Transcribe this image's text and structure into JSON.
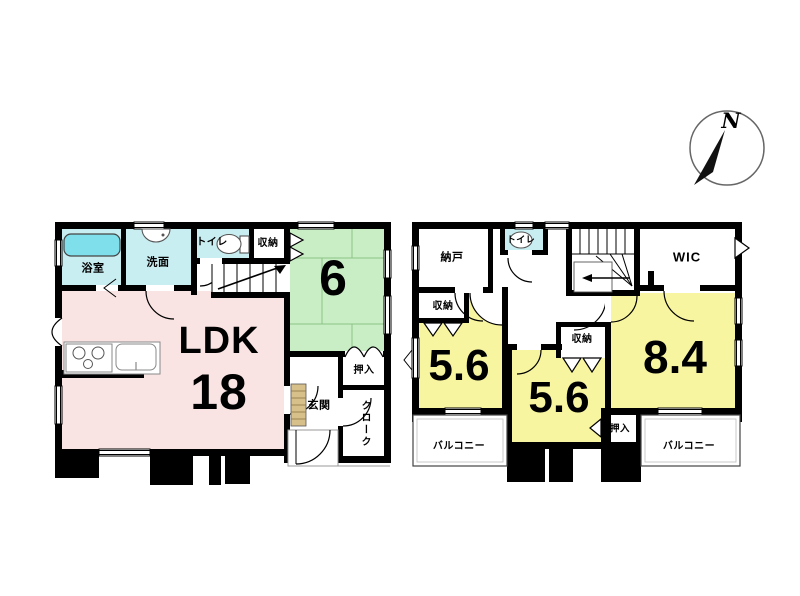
{
  "compass": {
    "label": "N"
  },
  "colors": {
    "wall": "#000000",
    "water_room": "#c9eef2",
    "bathtub": "#7fdfea",
    "tatami": "#c9eec6",
    "ldk": "#fae4e3",
    "bedroom": "#f8f5a0",
    "wood": "#d8c08a"
  },
  "floor1": {
    "bathroom": "浴室",
    "washroom": "洗面",
    "toilet": "トイレ",
    "storage": "収納",
    "tatami_size": "6",
    "ldk_label": "LDK",
    "ldk_size": "18",
    "oshiire": "押入",
    "genkan": "玄関",
    "cloak": "クローク"
  },
  "floor2": {
    "nando": "納戸",
    "toilet": "トイレ",
    "wic": "WIC",
    "storage_left": "収納",
    "storage_center": "収納",
    "room_left_size": "5.6",
    "room_center_size": "5.6",
    "room_right_size": "8.4",
    "oshiire": "押入",
    "balcony_left": "バルコニー",
    "balcony_right": "バルコニー"
  }
}
